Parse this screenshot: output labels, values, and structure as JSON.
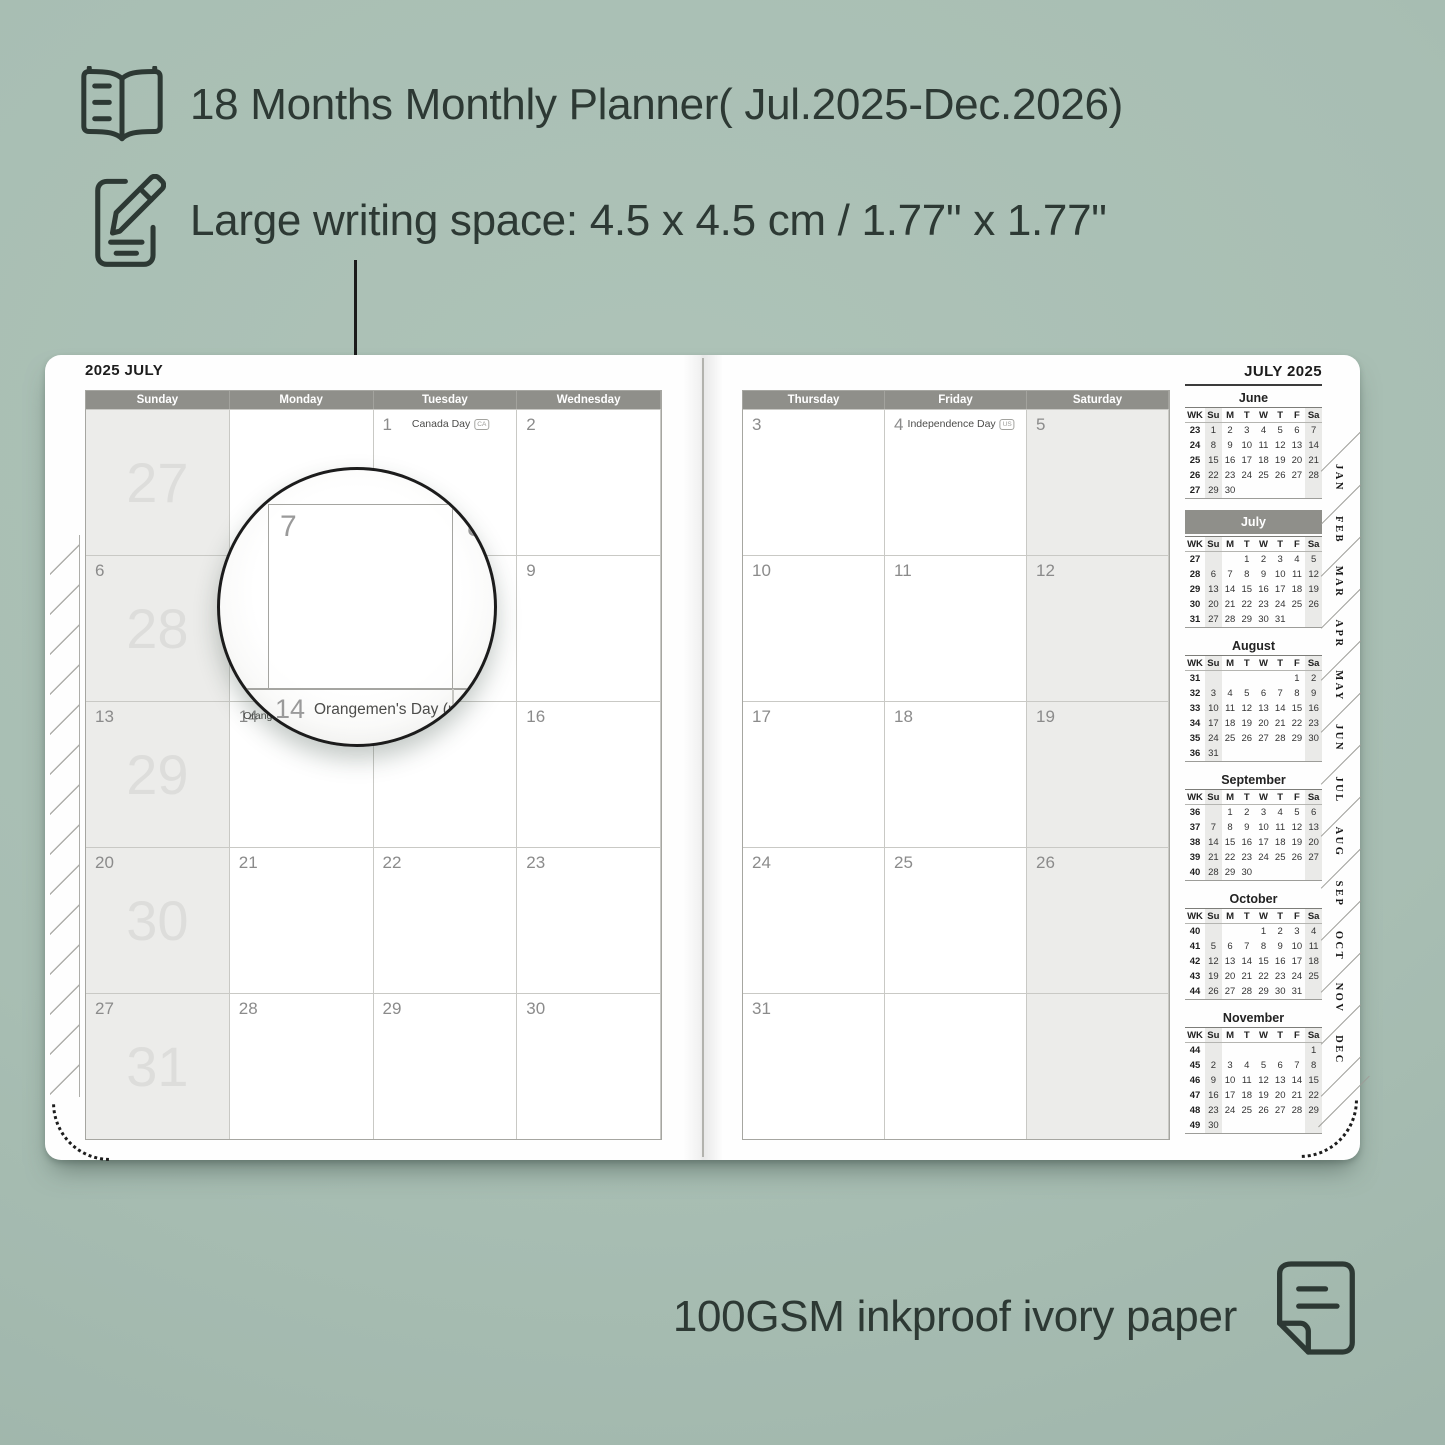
{
  "colors": {
    "background": "#a8beb3",
    "ink": "#2d3934",
    "header_bar": "#8f8f8a",
    "shaded_cell": "#ececea",
    "grid_line": "#c9c9c5",
    "date_text": "#8b8b8b",
    "watermark": "#dddddb"
  },
  "features": [
    {
      "icon": "open-book-icon",
      "text": "18 Months Monthly Planner( Jul.2025-Dec.2026)"
    },
    {
      "icon": "pencil-note-icon",
      "text": "Large writing space: 4.5 x 4.5 cm / 1.77\" x 1.77\""
    }
  ],
  "footer": {
    "text": "100GSM inkproof ivory paper",
    "icon": "paper-sheet-icon"
  },
  "planner": {
    "left_page": {
      "title": "2025 JULY",
      "day_headers": [
        "Sunday",
        "Monday",
        "Tuesday",
        "Wednesday"
      ],
      "rows": [
        [
          {
            "watermark": "27",
            "shaded": true
          },
          {},
          {
            "date": "1",
            "holiday": "Canada Day",
            "badge": "CA"
          },
          {
            "date": "2"
          }
        ],
        [
          {
            "date": "6",
            "watermark": "28",
            "shaded": true
          },
          {
            "date": "7"
          },
          {
            "date": "8"
          },
          {
            "date": "9"
          }
        ],
        [
          {
            "date": "13",
            "watermark": "29",
            "shaded": true
          },
          {
            "date": "14",
            "holiday": "Orangemen's Day (n.i.)",
            "badge": "UK"
          },
          {
            "date": "15"
          },
          {
            "date": "16"
          }
        ],
        [
          {
            "date": "20",
            "watermark": "30",
            "shaded": true
          },
          {
            "date": "21"
          },
          {
            "date": "22"
          },
          {
            "date": "23"
          }
        ],
        [
          {
            "date": "27",
            "watermark": "31",
            "shaded": true
          },
          {
            "date": "28"
          },
          {
            "date": "29"
          },
          {
            "date": "30"
          }
        ]
      ]
    },
    "right_page": {
      "day_headers": [
        "Thursday",
        "Friday",
        "Saturday"
      ],
      "rows": [
        [
          {
            "date": "3"
          },
          {
            "date": "4",
            "holiday": "Independence Day",
            "badge": "US"
          },
          {
            "date": "5",
            "shaded": true
          }
        ],
        [
          {
            "date": "10"
          },
          {
            "date": "11"
          },
          {
            "date": "12",
            "shaded": true
          }
        ],
        [
          {
            "date": "17"
          },
          {
            "date": "18"
          },
          {
            "date": "19",
            "shaded": true
          }
        ],
        [
          {
            "date": "24"
          },
          {
            "date": "25"
          },
          {
            "date": "26",
            "shaded": true
          }
        ],
        [
          {
            "date": "31"
          },
          {},
          {
            "shaded": true
          }
        ]
      ]
    },
    "magnifier": {
      "cell_date": "7",
      "next_date": "8",
      "below_date": "14",
      "below_holiday": "Orangemen's Day (n.i.)",
      "below_badge": "UK"
    },
    "sidebar": {
      "title": "JULY 2025",
      "mini_header": [
        "WK",
        "Su",
        "M",
        "T",
        "W",
        "T",
        "F",
        "Sa"
      ],
      "months": [
        {
          "name": "June",
          "highlight": false,
          "weeks": [
            [
              "23",
              "1",
              "2",
              "3",
              "4",
              "5",
              "6",
              "7"
            ],
            [
              "24",
              "8",
              "9",
              "10",
              "11",
              "12",
              "13",
              "14"
            ],
            [
              "25",
              "15",
              "16",
              "17",
              "18",
              "19",
              "20",
              "21"
            ],
            [
              "26",
              "22",
              "23",
              "24",
              "25",
              "26",
              "27",
              "28"
            ],
            [
              "27",
              "29",
              "30",
              "",
              "",
              "",
              "",
              ""
            ]
          ]
        },
        {
          "name": "July",
          "highlight": true,
          "weeks": [
            [
              "27",
              "",
              "",
              "1",
              "2",
              "3",
              "4",
              "5"
            ],
            [
              "28",
              "6",
              "7",
              "8",
              "9",
              "10",
              "11",
              "12"
            ],
            [
              "29",
              "13",
              "14",
              "15",
              "16",
              "17",
              "18",
              "19"
            ],
            [
              "30",
              "20",
              "21",
              "22",
              "23",
              "24",
              "25",
              "26"
            ],
            [
              "31",
              "27",
              "28",
              "29",
              "30",
              "31",
              "",
              ""
            ]
          ]
        },
        {
          "name": "August",
          "highlight": false,
          "weeks": [
            [
              "31",
              "",
              "",
              "",
              "",
              "",
              "1",
              "2"
            ],
            [
              "32",
              "3",
              "4",
              "5",
              "6",
              "7",
              "8",
              "9"
            ],
            [
              "33",
              "10",
              "11",
              "12",
              "13",
              "14",
              "15",
              "16"
            ],
            [
              "34",
              "17",
              "18",
              "19",
              "20",
              "21",
              "22",
              "23"
            ],
            [
              "35",
              "24",
              "25",
              "26",
              "27",
              "28",
              "29",
              "30"
            ],
            [
              "36",
              "31",
              "",
              "",
              "",
              "",
              "",
              ""
            ]
          ]
        },
        {
          "name": "September",
          "highlight": false,
          "weeks": [
            [
              "36",
              "",
              "1",
              "2",
              "3",
              "4",
              "5",
              "6"
            ],
            [
              "37",
              "7",
              "8",
              "9",
              "10",
              "11",
              "12",
              "13"
            ],
            [
              "38",
              "14",
              "15",
              "16",
              "17",
              "18",
              "19",
              "20"
            ],
            [
              "39",
              "21",
              "22",
              "23",
              "24",
              "25",
              "26",
              "27"
            ],
            [
              "40",
              "28",
              "29",
              "30",
              "",
              "",
              "",
              ""
            ]
          ]
        },
        {
          "name": "October",
          "highlight": false,
          "weeks": [
            [
              "40",
              "",
              "",
              "",
              "1",
              "2",
              "3",
              "4"
            ],
            [
              "41",
              "5",
              "6",
              "7",
              "8",
              "9",
              "10",
              "11"
            ],
            [
              "42",
              "12",
              "13",
              "14",
              "15",
              "16",
              "17",
              "18"
            ],
            [
              "43",
              "19",
              "20",
              "21",
              "22",
              "23",
              "24",
              "25"
            ],
            [
              "44",
              "26",
              "27",
              "28",
              "29",
              "30",
              "31",
              ""
            ]
          ]
        },
        {
          "name": "November",
          "highlight": false,
          "weeks": [
            [
              "44",
              "",
              "",
              "",
              "",
              "",
              "",
              "1"
            ],
            [
              "45",
              "2",
              "3",
              "4",
              "5",
              "6",
              "7",
              "8"
            ],
            [
              "46",
              "9",
              "10",
              "11",
              "12",
              "13",
              "14",
              "15"
            ],
            [
              "47",
              "16",
              "17",
              "18",
              "19",
              "20",
              "21",
              "22"
            ],
            [
              "48",
              "23",
              "24",
              "25",
              "26",
              "27",
              "28",
              "29"
            ],
            [
              "49",
              "30",
              "",
              "",
              "",
              "",
              "",
              ""
            ]
          ]
        }
      ],
      "tabs": [
        "JAN",
        "FEB",
        "MAR",
        "APR",
        "MAY",
        "JUN",
        "JUL",
        "AUG",
        "SEP",
        "OCT",
        "NOV",
        "DEC"
      ]
    }
  }
}
